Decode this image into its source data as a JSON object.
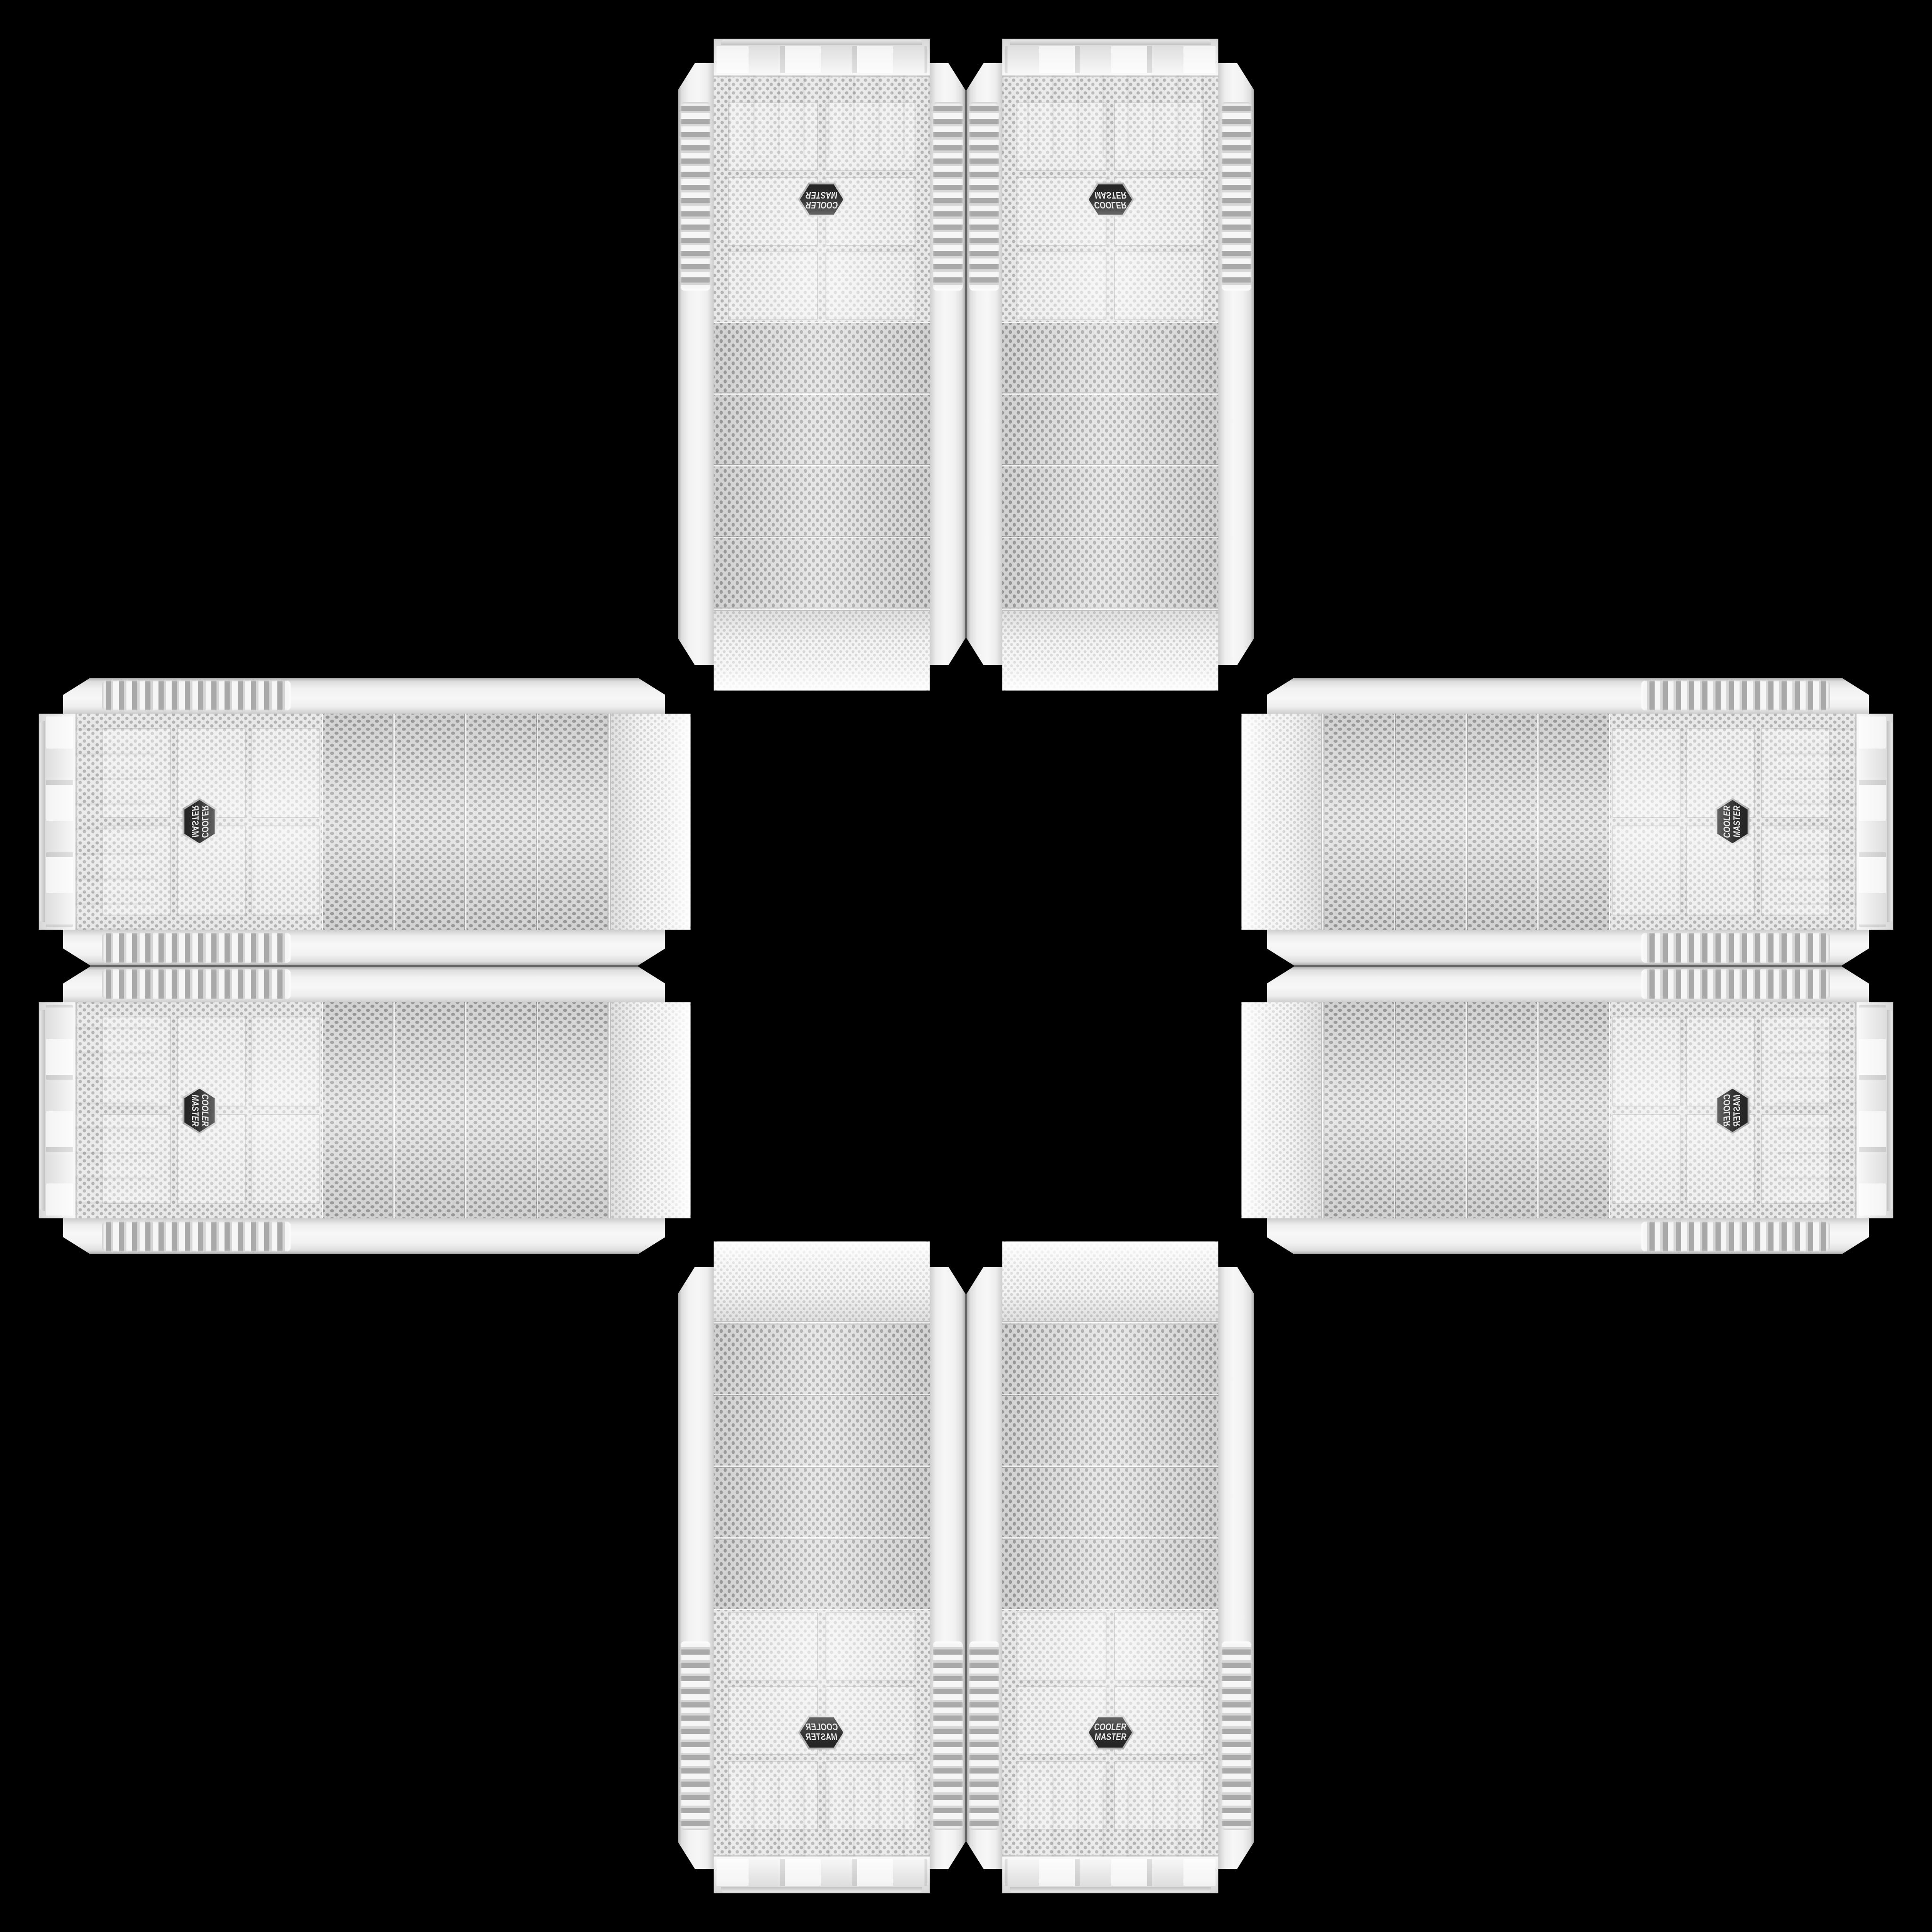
{
  "scene": {
    "type": "product-collage",
    "description": "Eight identical white Cooler Master mesh-front PC tower cases arranged in a symmetric cross / plus pattern on a black background; each arm is a mirrored pair, feet facing outward and mesh top caps facing the center",
    "background_color": "#000000",
    "arrangement": "cross",
    "case_count": 8
  },
  "brand": "Cooler Master",
  "logo": {
    "line1": "COOLER",
    "line2": "MASTER",
    "badge_shape": "hexagon",
    "badge_color": "#2e2e2e",
    "badge_rim_color": "#d9d9d9",
    "badge_text_color": "#ebebeb"
  },
  "case_style": {
    "body_color": "#f2f2f2",
    "mesh_color": "#e8e8e8",
    "mesh_dot_color": "#a8a8a8",
    "front": "perforated dot mesh",
    "drive_bay_covers_per_case": 4,
    "side_grips": "ribbed rubber-style strips on both rails"
  },
  "cases": [
    {
      "id": "top-left",
      "orientation": "rotated-180"
    },
    {
      "id": "top-right",
      "orientation": "flipped-vertical"
    },
    {
      "id": "left-top",
      "orientation": "rotated-90-ccw-mirrored"
    },
    {
      "id": "left-bottom",
      "orientation": "rotated-90-cw"
    },
    {
      "id": "right-top",
      "orientation": "rotated-90-ccw"
    },
    {
      "id": "right-bottom",
      "orientation": "rotated-90-cw-mirrored"
    },
    {
      "id": "bottom-left",
      "orientation": "flipped-horizontal"
    },
    {
      "id": "bottom-right",
      "orientation": "upright"
    }
  ]
}
